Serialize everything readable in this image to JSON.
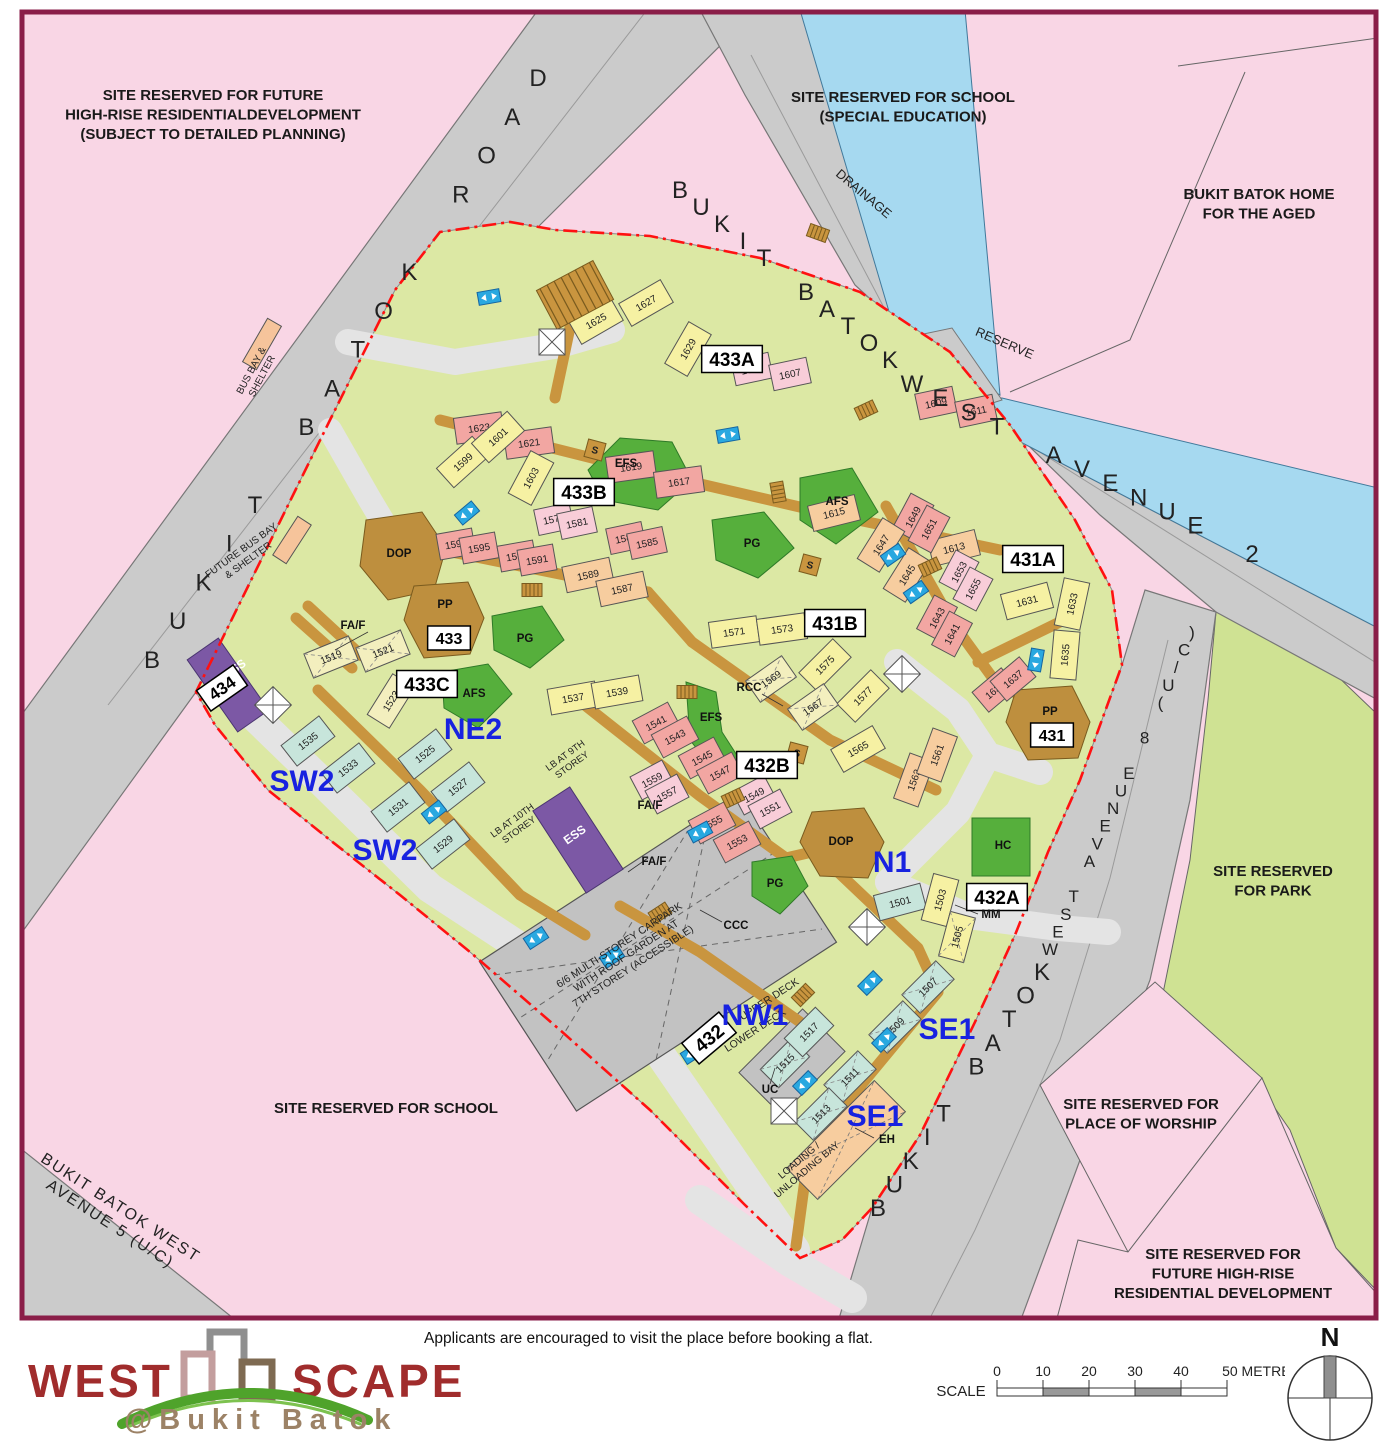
{
  "colors": {
    "border": "#8A1E48",
    "pink": "#F9D6E5",
    "road": "#CBCBCB",
    "road_line": "#777777",
    "water": "#A6D9F0",
    "water_line": "#41799B",
    "site_green": "#DCE8A4",
    "park_green": "#CFE293",
    "dark_green": "#56AF3C",
    "dark_green_line": "#2F7A28",
    "linkway": "#C9953F",
    "linkway_line": "#8A6520",
    "blob": "#BE8F3E",
    "purple": "#7C58A5",
    "carpark": "#C2C2C2",
    "red": "#FF1111",
    "zone_blue": "#1822E0",
    "lift": "#29A8E0",
    "logo_red": "#A02C2C",
    "logo_brown": "#9C8266",
    "swoosh": "#4FA32B",
    "block_colors": {
      "y": "#F6F1A3",
      "py": "#F3EFBE",
      "p": "#F2A6A2",
      "lp": "#F8CDD8",
      "pe": "#F7CD9F",
      "t": "#C7E5DB"
    }
  },
  "note": "Applicants are encouraged to visit the place before booking a flat.",
  "logo": {
    "west": "WEST",
    "scape": "SCAPE",
    "sub": "@Bukit Batok"
  },
  "scale_bar": {
    "label": "SCALE",
    "ticks": [
      "0",
      "10",
      "20",
      "30",
      "40"
    ],
    "end_label": "50 METRES"
  },
  "compass": {
    "north": "N"
  },
  "site_labels": [
    {
      "lines": [
        "SITE RESERVED FOR FUTURE",
        "HIGH-RISE RESIDENTIALDEVELOPMENT",
        "(SUBJECT TO DETAILED PLANNING)"
      ],
      "x": 213,
      "y": 100
    },
    {
      "lines": [
        "SITE RESERVED FOR SCHOOL",
        "(SPECIAL EDUCATION)"
      ],
      "x": 903,
      "y": 102
    },
    {
      "lines": [
        "BUKIT BATOK HOME",
        "FOR THE AGED"
      ],
      "x": 1259,
      "y": 199
    },
    {
      "lines": [
        "SITE RESERVED",
        "FOR PARK"
      ],
      "x": 1273,
      "y": 876
    },
    {
      "lines": [
        "SITE RESERVED FOR",
        "PLACE OF WORSHIP"
      ],
      "x": 1141,
      "y": 1109
    },
    {
      "lines": [
        "SITE RESERVED FOR",
        "FUTURE HIGH-RISE",
        "RESIDENTIAL DEVELOPMENT"
      ],
      "x": 1223,
      "y": 1259
    },
    {
      "lines": [
        "SITE RESERVED FOR SCHOOL"
      ],
      "x": 386,
      "y": 1113
    }
  ],
  "road_names": [
    {
      "text": "BUKIT BATOK ROAD",
      "x1": 152,
      "y1": 668,
      "x2": 538,
      "y2": 86,
      "s": 24
    },
    {
      "text": "BUKIT BATOK",
      "x1": 680,
      "y1": 198,
      "x2": 890,
      "y2": 368,
      "s": 24
    },
    {
      "text": "WEST AVENUE 2",
      "x1": 912,
      "y1": 392,
      "x2": 1252,
      "y2": 562,
      "s": 24
    },
    {
      "text": "BUKIT BATOK",
      "x1": 878,
      "y1": 1216,
      "x2": 1042,
      "y2": 980,
      "s": 24
    },
    {
      "text": "WEST AVENUE 8 (U/C)",
      "x1": 1050,
      "y1": 955,
      "x2": 1192,
      "y2": 638,
      "s": 17
    }
  ],
  "rotated_labels": [
    {
      "lines": [
        "DRAINAGE"
      ],
      "x": 861,
      "y": 197,
      "r": 40,
      "s": 13
    },
    {
      "lines": [
        "RESERVE"
      ],
      "x": 1003,
      "y": 347,
      "r": 23,
      "s": 13
    },
    {
      "lines": [
        "BUKIT BATOK WEST",
        "AVENUE 5 (U/C)"
      ],
      "x": 118,
      "y": 1212,
      "r": 33,
      "s": 16
    },
    {
      "lines": [
        "BUS BAY &",
        "SHELTER"
      ],
      "x": 254,
      "y": 372,
      "r": -62,
      "s": 10
    },
    {
      "lines": [
        "FUTURE BUS BAY",
        "& SHELTER"
      ],
      "x": 243,
      "y": 553,
      "r": -36,
      "s": 10
    },
    {
      "lines": [
        "ESS"
      ],
      "x": 237,
      "y": 672,
      "r": -35,
      "s": 12,
      "c": "#FFFFFF",
      "b": 1
    },
    {
      "lines": [
        "ESS"
      ],
      "x": 577,
      "y": 838,
      "r": -35,
      "s": 12,
      "c": "#FFFFFF",
      "b": 1
    },
    {
      "lines": [
        "LB AT 9TH",
        "STOREY"
      ],
      "x": 567,
      "y": 758,
      "r": -36,
      "s": 9.5
    },
    {
      "lines": [
        "LB AT 10TH",
        "STOREY"
      ],
      "x": 514,
      "y": 823,
      "r": -36,
      "s": 9.5
    },
    {
      "lines": [
        "6/6 MULTI-STOREY CARPARK",
        "WITH ROOF GARDEN AT",
        "7TH STOREY (ACCESSIBLE)"
      ],
      "x": 621,
      "y": 948,
      "r": -33,
      "s": 10.5
    },
    {
      "lines": [
        "UPPER DECK"
      ],
      "x": 771,
      "y": 1002,
      "r": -33,
      "s": 10.5
    },
    {
      "lines": [
        "LOWER DECK"
      ],
      "x": 757,
      "y": 1033,
      "r": -33,
      "s": 10.5
    },
    {
      "lines": [
        "LOADING /",
        "UNLOADING BAY"
      ],
      "x": 801,
      "y": 1163,
      "r": -40,
      "s": 10
    }
  ],
  "precinct_boxes": [
    {
      "label": "433A",
      "x": 732,
      "y": 359,
      "r": 0,
      "s": 19
    },
    {
      "label": "433B",
      "x": 584,
      "y": 492,
      "r": 0,
      "s": 19
    },
    {
      "label": "433C",
      "x": 427,
      "y": 684,
      "r": 0,
      "s": 19
    },
    {
      "label": "431A",
      "x": 1033,
      "y": 559,
      "r": 0,
      "s": 19
    },
    {
      "label": "431B",
      "x": 835,
      "y": 623,
      "r": 0,
      "s": 19
    },
    {
      "label": "432A",
      "x": 997,
      "y": 897,
      "r": 0,
      "s": 19
    },
    {
      "label": "432B",
      "x": 767,
      "y": 765,
      "r": 0,
      "s": 19
    },
    {
      "label": "434",
      "x": 222,
      "y": 688,
      "r": -35,
      "s": 17
    },
    {
      "label": "432",
      "x": 709,
      "y": 1038,
      "r": -40,
      "s": 19
    },
    {
      "label": "433",
      "x": 449,
      "y": 638,
      "r": 0,
      "s": 16
    },
    {
      "label": "431",
      "x": 1052,
      "y": 735,
      "r": 0,
      "s": 16
    }
  ],
  "zone_labels": [
    {
      "label": "NE2",
      "x": 473,
      "y": 739
    },
    {
      "label": "SW2",
      "x": 302,
      "y": 791
    },
    {
      "label": "SW2",
      "x": 385,
      "y": 860
    },
    {
      "label": "N1",
      "x": 892,
      "y": 872
    },
    {
      "label": "NW1",
      "x": 755,
      "y": 1025
    },
    {
      "label": "SE1",
      "x": 947,
      "y": 1039
    },
    {
      "label": "SE1",
      "x": 875,
      "y": 1126
    }
  ],
  "blocks": [
    [
      "1625",
      596,
      321,
      -30,
      "y"
    ],
    [
      "1627",
      646,
      303,
      -30,
      "y"
    ],
    [
      "1629",
      688,
      349,
      -60,
      "y"
    ],
    [
      "1605",
      752,
      369,
      -12,
      "lp",
      38
    ],
    [
      "1607",
      790,
      374,
      -12,
      "lp",
      38
    ],
    [
      "1609",
      936,
      403,
      -12,
      "p",
      38
    ],
    [
      "1611",
      976,
      411,
      -12,
      "p",
      38
    ],
    [
      "1623",
      479,
      428,
      -8,
      "p"
    ],
    [
      "1621",
      529,
      443,
      -8,
      "p"
    ],
    [
      "1619",
      631,
      467,
      -8,
      "p"
    ],
    [
      "1617",
      679,
      482,
      -8,
      "p"
    ],
    [
      "1615",
      834,
      513,
      -14,
      "pe"
    ],
    [
      "1613",
      954,
      548,
      -14,
      "pe"
    ],
    [
      "1599",
      463,
      462,
      -42,
      "y"
    ],
    [
      "1601",
      498,
      437,
      -42,
      "y"
    ],
    [
      "1603",
      531,
      478,
      -62,
      "y"
    ],
    [
      "1579",
      554,
      519,
      -12,
      "lp",
      36
    ],
    [
      "1581",
      577,
      523,
      -12,
      "lp",
      36
    ],
    [
      "1583",
      626,
      538,
      -12,
      "p",
      36
    ],
    [
      "1585",
      647,
      543,
      -12,
      "p",
      36
    ],
    [
      "1597",
      456,
      544,
      -10,
      "p",
      36
    ],
    [
      "1595",
      479,
      548,
      -10,
      "p",
      36
    ],
    [
      "1593",
      517,
      556,
      -10,
      "p",
      36
    ],
    [
      "1591",
      537,
      560,
      -10,
      "p",
      36
    ],
    [
      "1589",
      588,
      575,
      -12,
      "pe"
    ],
    [
      "1587",
      622,
      589,
      -12,
      "pe"
    ],
    [
      "1519",
      331,
      657,
      -22,
      "py",
      48,
      1
    ],
    [
      "1521",
      383,
      651,
      -22,
      "py",
      48,
      1
    ],
    [
      "1523",
      391,
      701,
      -58,
      "py"
    ],
    [
      "1535",
      308,
      741,
      -38,
      "t"
    ],
    [
      "1533",
      348,
      768,
      -38,
      "t"
    ],
    [
      "1525",
      425,
      754,
      -38,
      "t"
    ],
    [
      "1527",
      458,
      787,
      -38,
      "t"
    ],
    [
      "1531",
      398,
      807,
      -38,
      "t"
    ],
    [
      "1529",
      443,
      844,
      -38,
      "t"
    ],
    [
      "1649",
      913,
      517,
      -62,
      "p",
      40
    ],
    [
      "1651",
      929,
      529,
      -62,
      "p",
      40
    ],
    [
      "1647",
      881,
      545,
      -58,
      "pe"
    ],
    [
      "1645",
      907,
      575,
      -58,
      "pe"
    ],
    [
      "1653",
      959,
      572,
      -62,
      "lp",
      36
    ],
    [
      "1655",
      973,
      589,
      -62,
      "lp",
      36
    ],
    [
      "1643",
      937,
      618,
      -62,
      "p",
      38
    ],
    [
      "1641",
      952,
      634,
      -62,
      "p",
      38
    ],
    [
      "1631",
      1027,
      601,
      -15,
      "y"
    ],
    [
      "1633",
      1072,
      604,
      -78,
      "y"
    ],
    [
      "1635",
      1065,
      655,
      -85,
      "y"
    ],
    [
      "1639",
      995,
      690,
      -40,
      "p",
      38
    ],
    [
      "1637",
      1013,
      679,
      -40,
      "p",
      38
    ],
    [
      "1571",
      734,
      632,
      -8,
      "y"
    ],
    [
      "1573",
      782,
      629,
      -8,
      "y"
    ],
    [
      "1575",
      825,
      665,
      -45,
      "y"
    ],
    [
      "1577",
      863,
      696,
      -45,
      "y"
    ],
    [
      "1569",
      771,
      679,
      -35,
      "py",
      44,
      1
    ],
    [
      "1567",
      813,
      707,
      -35,
      "py",
      44,
      1
    ],
    [
      "1565",
      858,
      749,
      -30,
      "y"
    ],
    [
      "1563",
      914,
      780,
      -70,
      "pe"
    ],
    [
      "1561",
      937,
      755,
      -70,
      "pe"
    ],
    [
      "1537",
      573,
      698,
      -10,
      "y"
    ],
    [
      "1539",
      617,
      692,
      -10,
      "y"
    ],
    [
      "1541",
      656,
      723,
      -28,
      "p",
      40
    ],
    [
      "1543",
      675,
      737,
      -28,
      "p",
      40
    ],
    [
      "1545",
      702,
      758,
      -28,
      "p",
      40
    ],
    [
      "1547",
      720,
      773,
      -28,
      "p",
      40
    ],
    [
      "1549",
      754,
      795,
      -28,
      "lp",
      36
    ],
    [
      "1551",
      770,
      809,
      -28,
      "lp",
      36
    ],
    [
      "1559",
      652,
      780,
      -28,
      "lp",
      36
    ],
    [
      "1557",
      667,
      794,
      -28,
      "lp",
      36
    ],
    [
      "1555",
      712,
      823,
      -28,
      "p",
      40
    ],
    [
      "1553",
      737,
      842,
      -28,
      "p",
      40
    ],
    [
      "1501",
      900,
      902,
      -15,
      "t"
    ],
    [
      "1503",
      940,
      900,
      -75,
      "y"
    ],
    [
      "1505",
      957,
      937,
      -75,
      "y",
      46,
      1
    ],
    [
      "1507",
      928,
      987,
      -45,
      "t",
      48,
      1
    ],
    [
      "1509",
      895,
      1027,
      -45,
      "t",
      48,
      1
    ],
    [
      "1511",
      850,
      1077,
      -45,
      "t",
      48,
      1
    ],
    [
      "1513",
      821,
      1114,
      -45,
      "t",
      48,
      1
    ],
    [
      "1515",
      785,
      1063,
      -45,
      "t",
      44,
      1
    ],
    [
      "1517",
      809,
      1032,
      -45,
      "t",
      44
    ]
  ],
  "facility_labels": [
    [
      "EFS",
      626,
      467
    ],
    [
      "AFS",
      837,
      505
    ],
    [
      "PG",
      752,
      547
    ],
    [
      "EFS",
      711,
      721
    ],
    [
      "AFS",
      474,
      697
    ],
    [
      "PG",
      525,
      642
    ],
    [
      "PG",
      775,
      887
    ],
    [
      "HC",
      1003,
      849
    ],
    [
      "DOP",
      399,
      557
    ],
    [
      "DOP",
      841,
      845
    ],
    [
      "PP",
      445,
      608
    ],
    [
      "PP",
      1050,
      715
    ],
    [
      "RCC",
      749,
      691
    ],
    [
      "CCC",
      736,
      929
    ],
    [
      "MM",
      991,
      918
    ],
    [
      "EH",
      887,
      1143
    ],
    [
      "UC",
      770,
      1093
    ],
    [
      "FA/F",
      353,
      629
    ],
    [
      "FA/F",
      650,
      809
    ],
    [
      "FA/F",
      654,
      865
    ]
  ],
  "s_markers": [
    [
      595,
      450
    ],
    [
      810,
      565
    ],
    [
      797,
      753
    ]
  ]
}
